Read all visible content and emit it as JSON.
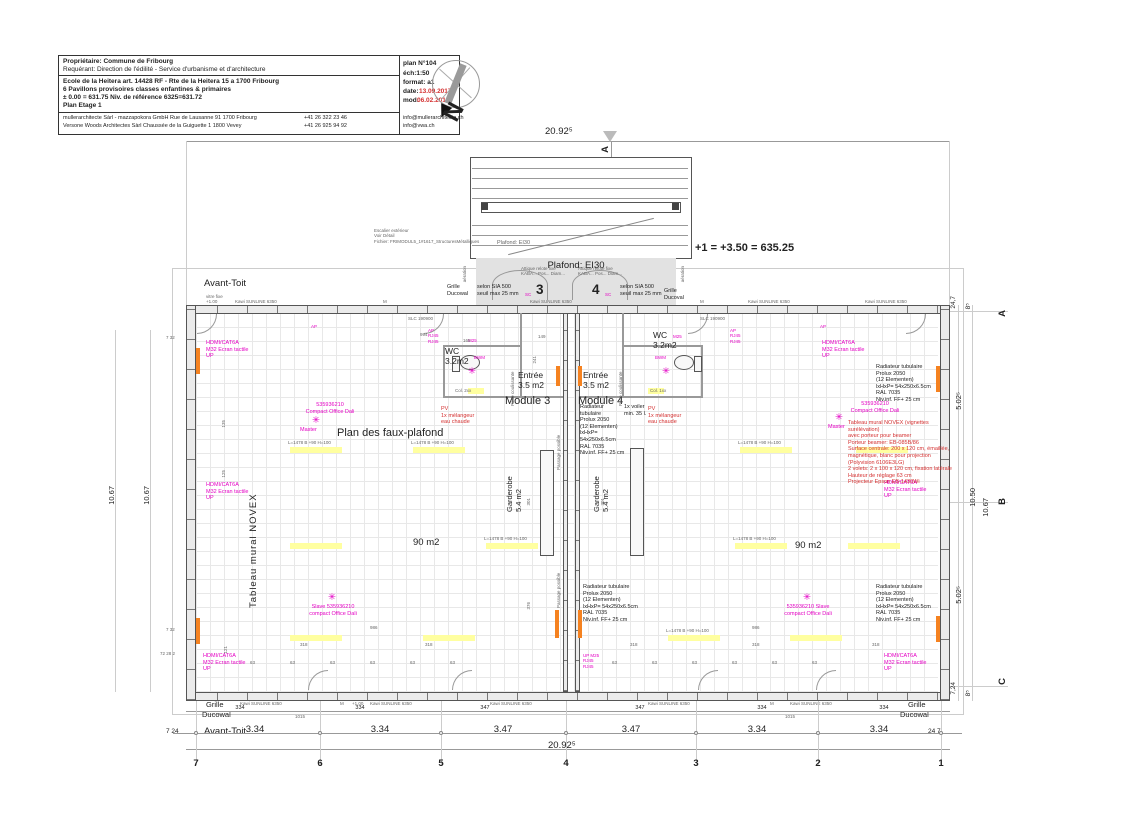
{
  "colors": {
    "magenta": "#e400c4",
    "red": "#d43030",
    "highlight_yellow": "#ffffa0",
    "orange": "#f58220",
    "wall_gray": "#ebebeb",
    "porch_gray": "#e2e2e2"
  },
  "title_block": {
    "owner": "Propriétaire: Commune de Fribourg",
    "applicant": "Requérant:   Direction de l'édilité - Service d'urbanisme et d'architecture",
    "project1": "Ecole de la Heitera art. 14428 RF - Rte de la Heitera 15 a 1700 Fribourg",
    "project2": "6 Pavillons  provisoires classes enfantines & primaires",
    "level_ref": "± 0.00 = 631.75   Niv. de référence 6325=631.72",
    "sheet": "Plan Etage 1",
    "arch1": "mullerarchitecte Sàrl - mazzapokora GmbH  Rue de Lausanne 91 1700 Fribourg",
    "arch1_tel": "+41 26 322 23 46",
    "arch1_mail": "info@mullerarchitecte.ch",
    "arch2": "Versone Woods Architectes Sàrl Chaussée de la Guiguette 1 1800 Vevey",
    "arch2_tel": "+41 26 925 94 92",
    "arch2_mail": "info@vwa.ch",
    "plan_no": "plan N°104",
    "scale": "éch:1:50",
    "format": "format: a1",
    "date_label": "date:",
    "date_value": "13.09.2017",
    "mod_label": "mod:",
    "mod_value": "06.02.2018"
  },
  "compass": {
    "n": "N"
  },
  "level_note": "+1 = +3.50 = 635.25",
  "stair": {
    "plafond": "Plafond: EI30",
    "note": "Escalier extérieur\nVoir Détail\nFichier: FRIMODUL5_1#1617_StructuresMétalliques"
  },
  "porch": {
    "plafond": "Plafond: EI30",
    "door3": "3",
    "door4": "4",
    "sc": "SC",
    "sia": "selon SIA 500\nseuil max 25 mm",
    "attique": "Attique relote fixe\nKABA...  Pos... Diam...",
    "anti_panique": "anti-panique",
    "grille_ducowal": "Grille\nDucowal",
    "grille_ducoval": "Grille\nDucoval",
    "aeration": "aération"
  },
  "labels": {
    "avant_toit": "Avant-Toit",
    "vitre_fixe": "vitre fixe\n+1.00",
    "wc": "WC\n3.2m2",
    "entree": "Entrée\n3.5 m2",
    "module3": "Module 3",
    "module4": "Module 4",
    "garderobe": "Garderobe\n5.4 m2",
    "area90": "90 m2",
    "faux_plafond": "Plan des faux-plafond",
    "tableau_novex": "Tableau mural NOVEX",
    "porte_coulissante": "Porte coulissante",
    "passage_possible": "Passage possible",
    "grille": "Grille",
    "ducowal": "Ducowal",
    "col_left": "Col. 2xx",
    "col_right": "Col. 1xx",
    "slc": "SLC 190900"
  },
  "electro": {
    "hdmi": "HDMI/CAT6A\nM32 Ecran  tactile\nUP",
    "ap": "AP",
    "ap_stack": "AP\nRJ45\nRJ45",
    "m25": "M25",
    "bwm": "BWM",
    "up_m25": "UP  M25\nRJ45\nRJ45",
    "dali_master": "535936210\nCompact Office Dali",
    "master": "Master",
    "dali_slave_left": "Slave  535936210\ncompact Office Dali",
    "dali_slave_right": "535936210  Slave\ncompact Office Dali",
    "flower": "✳"
  },
  "sanitary": {
    "pv": "PV\n1x mélangeur\neau chaude",
    "voilier": "1x voiler\nmin. 35 l."
  },
  "notes": {
    "radiator": "Radiateur tubulaire\nProlux  2050\n(12 Elementen)\nlxHxP= 54x250x6.5cm\nRAL 7035\nNiv.inf.  FF+ 25 cm",
    "novex": "Tableau mural NOVEX (vignettes surélévation)\navec porteur pour beamer\nPorteur beamer: EB-085B/86\nSurface centrale: 200 x 120 cm, émaillée,\nmagnétique, blanc pour projection\n(Polyvision 6106E3LG)\n2 volets: 2 x 100 x 120 cm, fixation latérale\nHauteur de réglage 63 cm\nProjecteur Epson EB-1430Wi"
  },
  "lights": {
    "label": "L=1478 B +90 H=100"
  },
  "windows": {
    "kawi": "Kawi SUNLINE 6350",
    "m": "M",
    "plus1": "+1.00"
  },
  "grid": {
    "cols": [
      "7",
      "6",
      "5",
      "4",
      "3",
      "2",
      "1"
    ],
    "rows": [
      "A",
      "B",
      "C"
    ]
  },
  "dims": {
    "total": "20.92⁵",
    "bays": [
      "3.34",
      "3.34",
      "3.47",
      "3.47",
      "3.34",
      "3.34"
    ],
    "subs": [
      "334",
      "334",
      "347",
      "347",
      "334",
      "334"
    ],
    "d1015": "1015",
    "edge_left": "7 24",
    "edge_right": "24 7",
    "right_top_a": "24,7",
    "right_top_b": "8⁵",
    "r502": "5.02⁵",
    "r1050": "10.50",
    "r1067": "10.67",
    "left_1067": "10.67",
    "bottom_left_edge": "7,24",
    "d994": "994",
    "d165": "165",
    "d149": "149",
    "d241": "241",
    "d301": "301",
    "d376": "376",
    "d318": "318",
    "d986": "986",
    "d63": "63",
    "d135": "135",
    "d125": "125",
    "d121": "121",
    "w732": "7  32",
    "w7282": "72  28  2",
    "section_a": "A"
  }
}
